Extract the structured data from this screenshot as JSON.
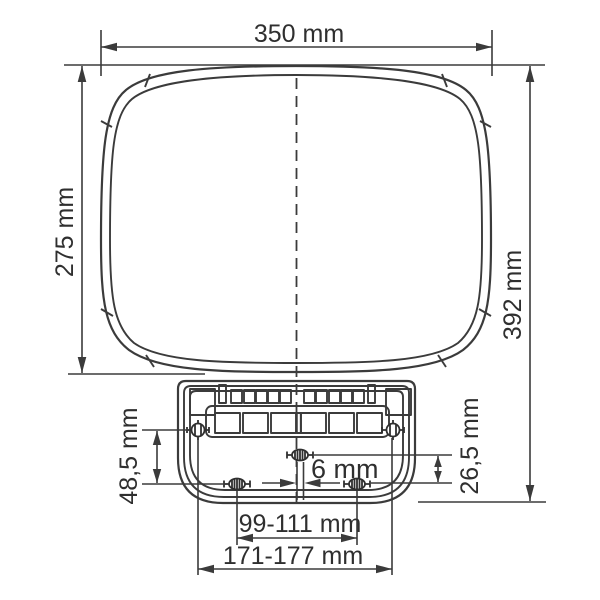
{
  "diagram": {
    "type": "technical dimension drawing (front view with wall-mount bracket)",
    "units": "mm",
    "colors": {
      "line": "#3b3b3b",
      "text": "#2f2f2f",
      "background": "#ffffff"
    },
    "labels": {
      "width_top": "350 mm",
      "height_body_left": "275 mm",
      "height_total_right": "392 mm",
      "offset_vertical_left": "48,5 mm",
      "offset_vertical_right": "26,5 mm",
      "offset_center": "6 mm",
      "holes_spacing_lower": "99-111 mm",
      "holes_spacing_upper": "171-177 mm"
    },
    "parts": {
      "body": "rounded front panel, double-line rim with segment ticks",
      "bracket": "mounting bracket with vent slots, terminal blocks and 5 screw holes",
      "centerline": "vertical dashed axis"
    }
  }
}
